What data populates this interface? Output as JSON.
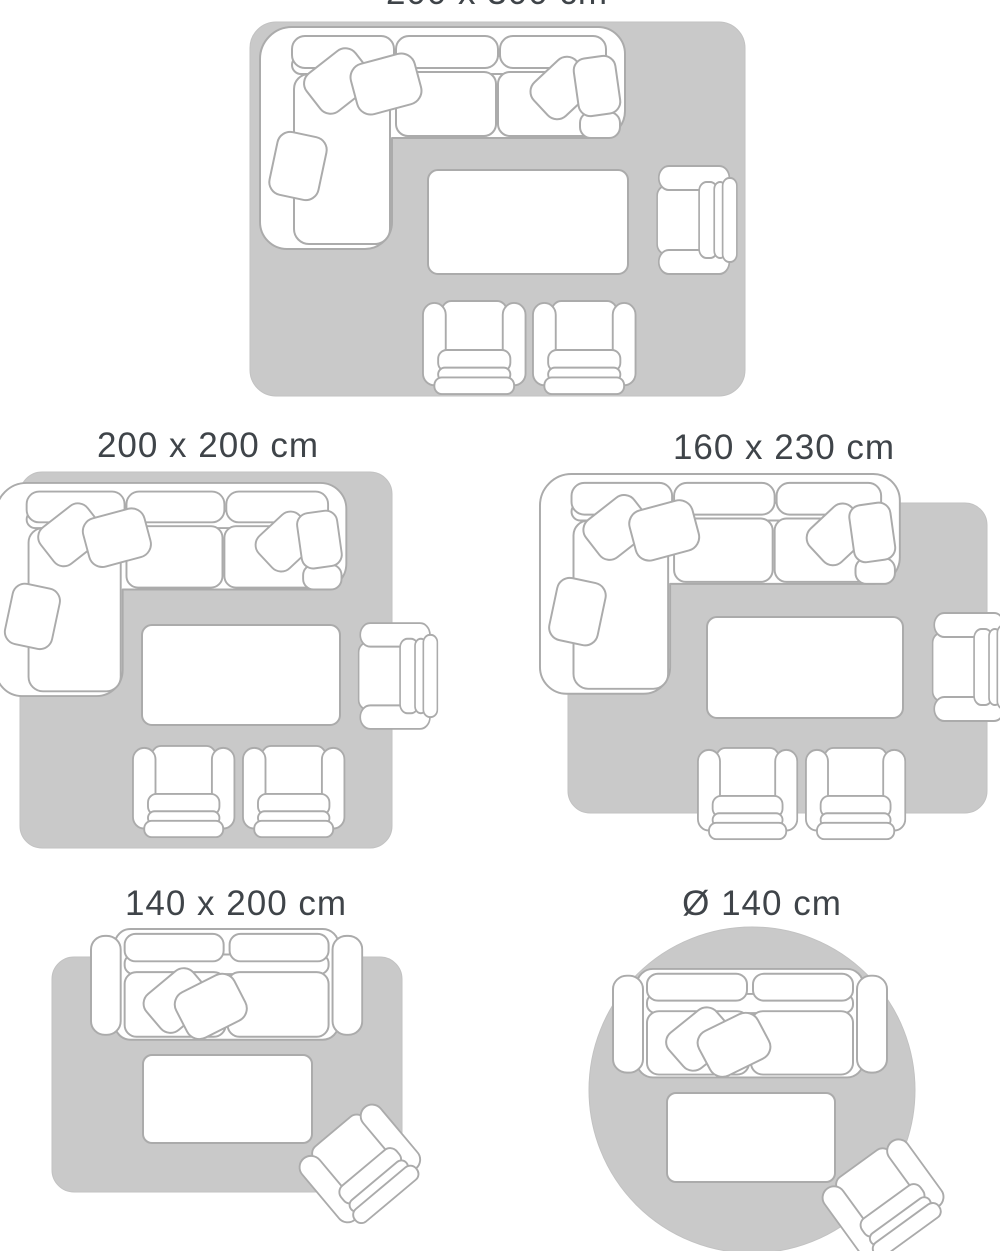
{
  "page": {
    "description": "Rug size guide with five living-room layout diagrams",
    "background_color": "#ffffff"
  },
  "colors": {
    "rug_fill": "#c9c9c9",
    "furniture_fill": "#ffffff",
    "furniture_outline": "#ababab",
    "title_text": "#3f4449"
  },
  "panels": [
    {
      "id": "200x300",
      "label": "200 x 300 cm",
      "label_cut_off_at_top": true,
      "rug_shape": "rectangle",
      "furniture": [
        "corner-sofa",
        "coffee-table",
        "armchair-right",
        "armchair-bottom-left",
        "armchair-bottom-right"
      ]
    },
    {
      "id": "200x200",
      "label": "200 x 200 cm",
      "rug_shape": "square",
      "furniture": [
        "corner-sofa",
        "coffee-table",
        "armchair-right",
        "armchair-bottom-left",
        "armchair-bottom-right"
      ]
    },
    {
      "id": "160x230",
      "label": "160 x 230 cm",
      "rug_shape": "rectangle",
      "furniture": [
        "corner-sofa",
        "coffee-table",
        "armchair-right",
        "armchair-bottom-left",
        "armchair-bottom-right"
      ]
    },
    {
      "id": "140x200",
      "label": "140 x 200 cm",
      "rug_shape": "rectangle",
      "furniture": [
        "two-seat-sofa",
        "coffee-table",
        "armchair-tilted"
      ]
    },
    {
      "id": "d140",
      "label": "Ø 140 cm",
      "rug_shape": "circle",
      "furniture": [
        "two-seat-sofa",
        "coffee-table",
        "armchair-tilted"
      ]
    }
  ]
}
